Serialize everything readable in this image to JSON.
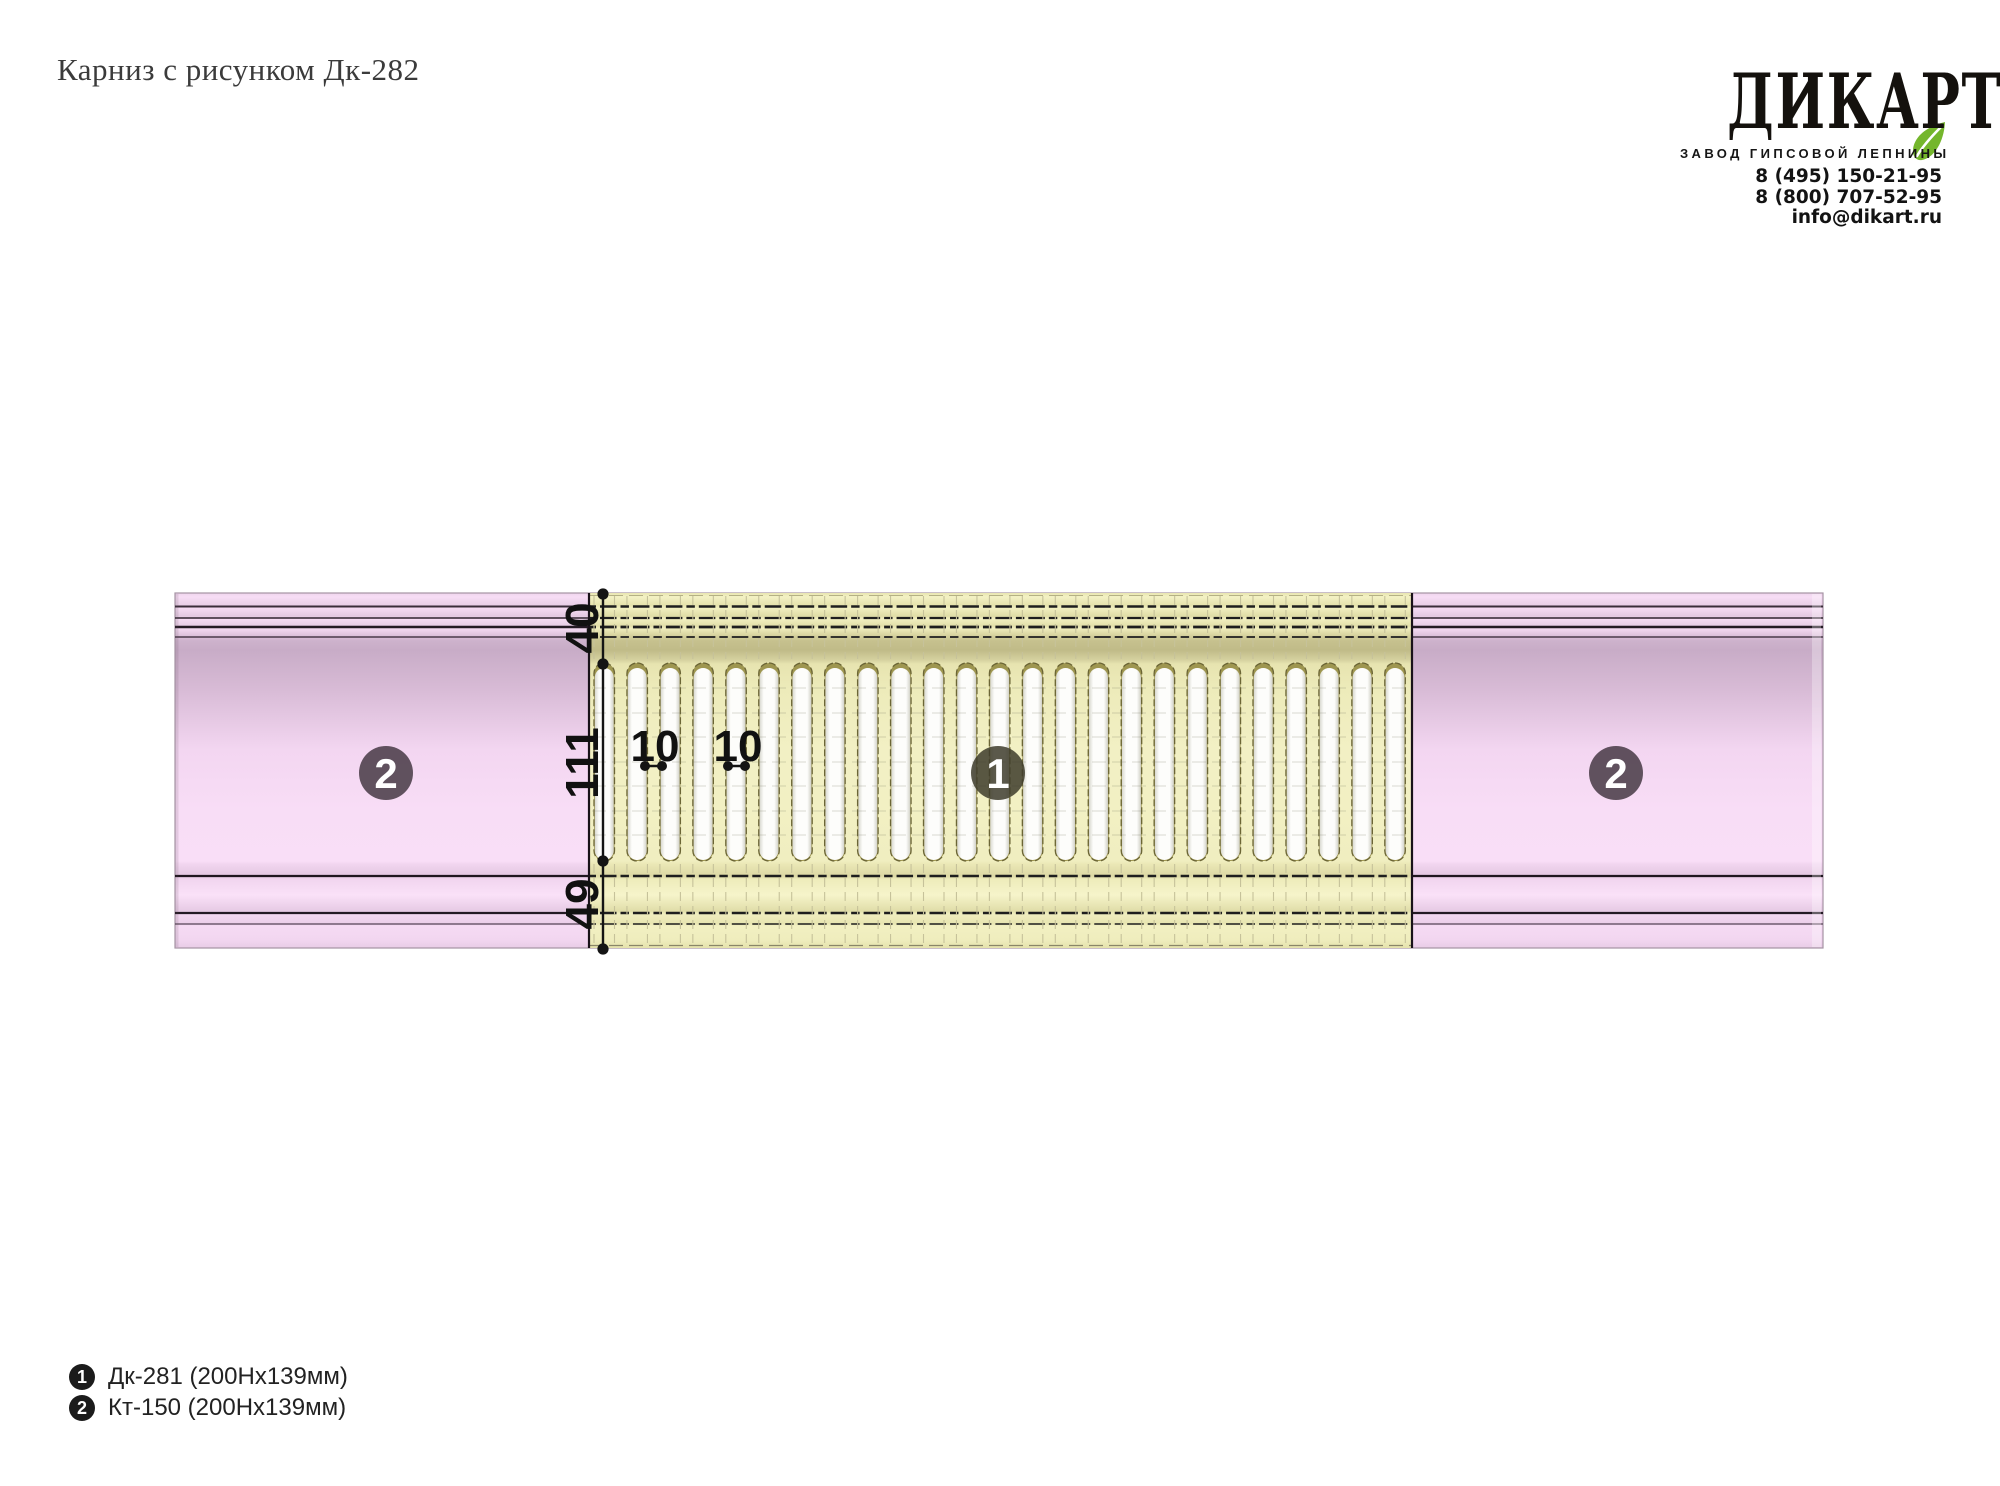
{
  "page": {
    "title": "Карниз с рисунком Дк-282"
  },
  "brand": {
    "logo": "ДИКАРТ",
    "tagline": "ЗАВОД ГИПСОВОЙ ЛЕПНИНЫ",
    "phone_1": "8 (495) 150-21-95",
    "phone_2": "8 (800) 707-52-95",
    "email": "info@dikart.ru"
  },
  "drawing": {
    "dims": {
      "d40": "40",
      "d111": "111",
      "d49": "49",
      "d10a": "10",
      "d10b": "10"
    },
    "markers": {
      "m1": "1",
      "m2": "2"
    },
    "colors": {
      "pink_base": "#f7ddf5",
      "yellow_base": "#f2f0c3",
      "slot_white": "#ffffff",
      "marker1_fill": "rgba(62,60,44,0.85)",
      "marker2_fill": "rgba(75,62,73,0.88)",
      "leaf_green": "#74b62c"
    },
    "slots": {
      "count": 25,
      "x0": 594,
      "pitch": 32.95,
      "width": 20.5,
      "y": 663,
      "height": 198,
      "top_band": [
        596,
        659
      ],
      "bottom_band": [
        864,
        944
      ]
    }
  },
  "legend": [
    {
      "num": "1",
      "label": "Дк-281 (200Нх139мм)"
    },
    {
      "num": "2",
      "label": "Кт-150 (200Нх139мм)"
    }
  ]
}
